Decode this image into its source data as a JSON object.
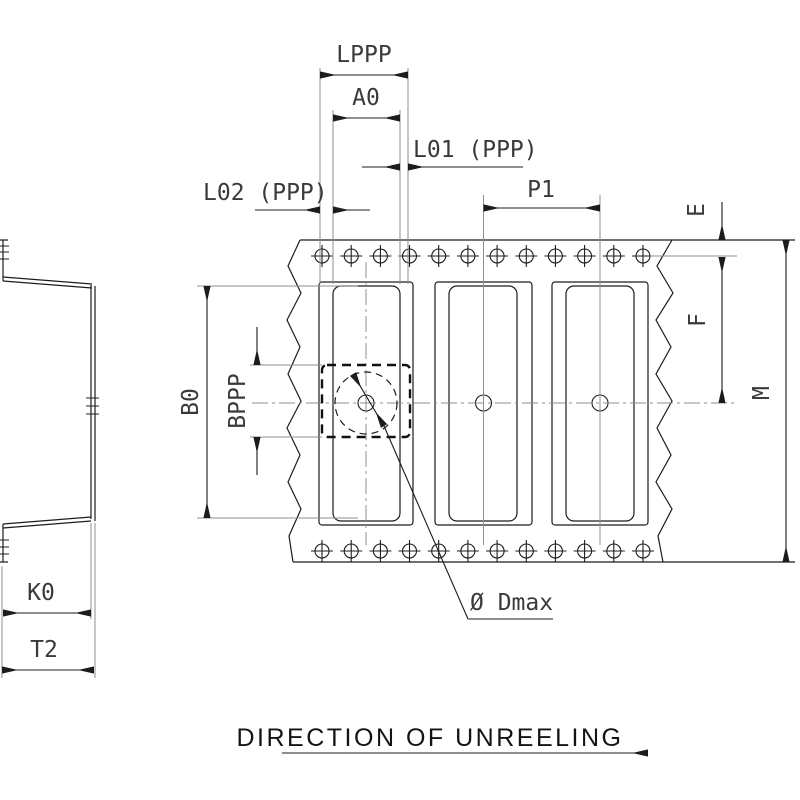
{
  "drawing": {
    "type": "carrier-tape packaging dimension drawing",
    "direction_label": "DIRECTION OF UNREELING",
    "dimension_labels": {
      "lppp": "LPPP",
      "a0": "A0",
      "l01": "L01 (PPP)",
      "l02": "L02 (PPP)",
      "p1": "P1",
      "e": "E",
      "f": "F",
      "m": "M",
      "b0": "B0",
      "bppp": "BPPP",
      "k0": "K0",
      "t2": "T2",
      "d_max": "Ø Dmax"
    },
    "colors": {
      "line": "#1c1c1c",
      "secondary_line": "#8f8f8f",
      "label_text": "#3a3a3a",
      "background": "#ffffff"
    }
  }
}
